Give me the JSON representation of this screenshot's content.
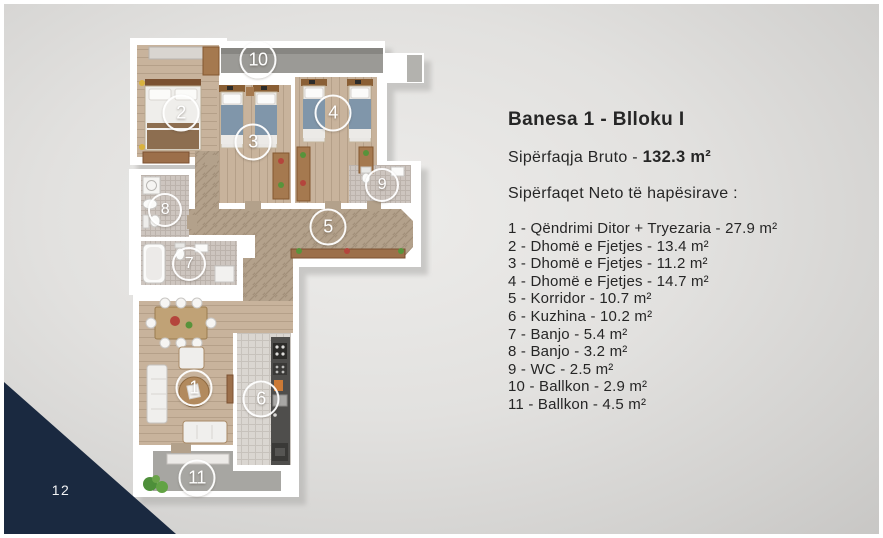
{
  "slide": {
    "page_number": "12",
    "corner_accent_color": "#1a2940"
  },
  "info": {
    "title": "Banesa 1 - Blloku I",
    "gross_label": "Sipërfaqja Bruto - ",
    "gross_value": "132.3 m²",
    "net_heading": "Sipërfaqet Neto të hapësirave :",
    "rooms": [
      "1 - Qëndrimi Ditor + Tryezaria - 27.9 m²",
      "2 - Dhomë e Fjetjes - 13.4 m²",
      "3 - Dhomë e Fjetjes - 11.2 m²",
      "4 - Dhomë e Fjetjes - 14.7 m²",
      "5 - Korridor - 10.7 m²",
      "6 - Kuzhina - 10.2 m²",
      "7 - Banjo - 5.4 m²",
      "8 - Banjo - 3.2 m²",
      "9 - WC - 2.5 m²",
      "10 - Ballkon - 2.9 m²",
      "11 - Ballkon - 4.5 m²"
    ]
  },
  "floorplan": {
    "markers": [
      "1",
      "2",
      "3",
      "4",
      "5",
      "6",
      "7",
      "8",
      "9",
      "10",
      "11"
    ]
  }
}
